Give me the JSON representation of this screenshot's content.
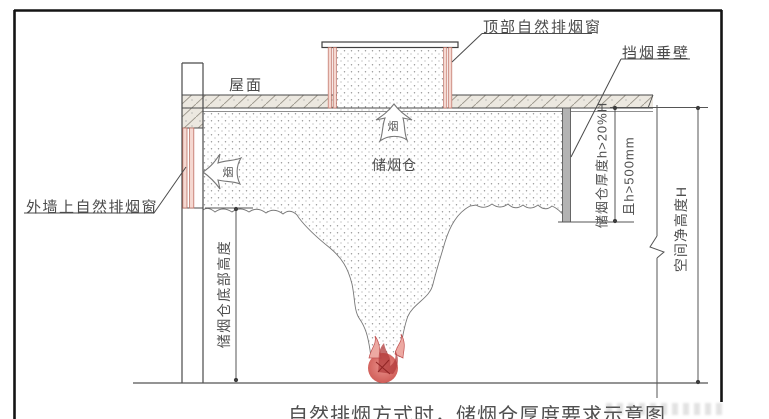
{
  "labels": {
    "roof": "屋面",
    "top_window": "顶部自然排烟窗",
    "smoke_barrier": "挡烟垂壁",
    "wall_window": "外墙上自然排烟窗",
    "smoke_reservoir": "储烟仓",
    "smoke_arrow_char": "烟"
  },
  "dimensions": {
    "reservoir_bottom_height": "储烟仓底部高度",
    "reservoir_thickness": "储烟仓厚度h>20%H",
    "thickness_min": "且h>500mm",
    "clear_height": "空间净高度H"
  },
  "caption": "自然排烟方式时，储烟仓厚度要求示意图",
  "colors": {
    "line": "#4a4a4a",
    "window_frame": "#bd6f63",
    "window_fill": "#f5d8d1",
    "barrier_fill": "#b3b3b3",
    "fire_red": "#d06060",
    "hatch_bg": "#ece8e0",
    "frame_border": "#141414"
  }
}
